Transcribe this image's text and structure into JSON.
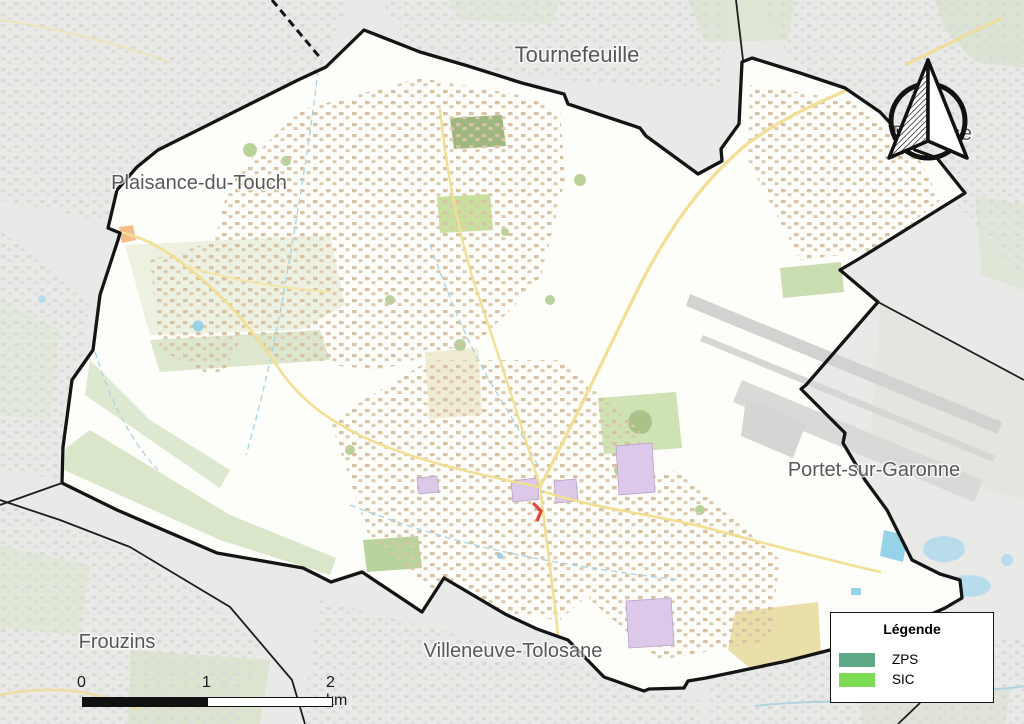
{
  "map_labels": {
    "tournefeuille": "Tournefeuille",
    "plaisance_du_touch": "Plaisance-du-Touch",
    "frouzins": "Frouzins",
    "villeneuve_tolosane": "Villeneuve-Tolosane",
    "portet_sur_garonne": "Portet-sur-Garonne",
    "toulouse": "Toulouse"
  },
  "legend": {
    "title": "Légende",
    "items": [
      {
        "label": "ZPS",
        "color": "#5fa987"
      },
      {
        "label": "SIC",
        "color": "#7edb55"
      }
    ]
  },
  "scale_bar": {
    "ticks": [
      "0",
      "1",
      "2 km"
    ]
  },
  "colors": {
    "boundary": "#141414",
    "outside_area": "#e9e9e7",
    "commune_fill": "#fdfdfa"
  }
}
